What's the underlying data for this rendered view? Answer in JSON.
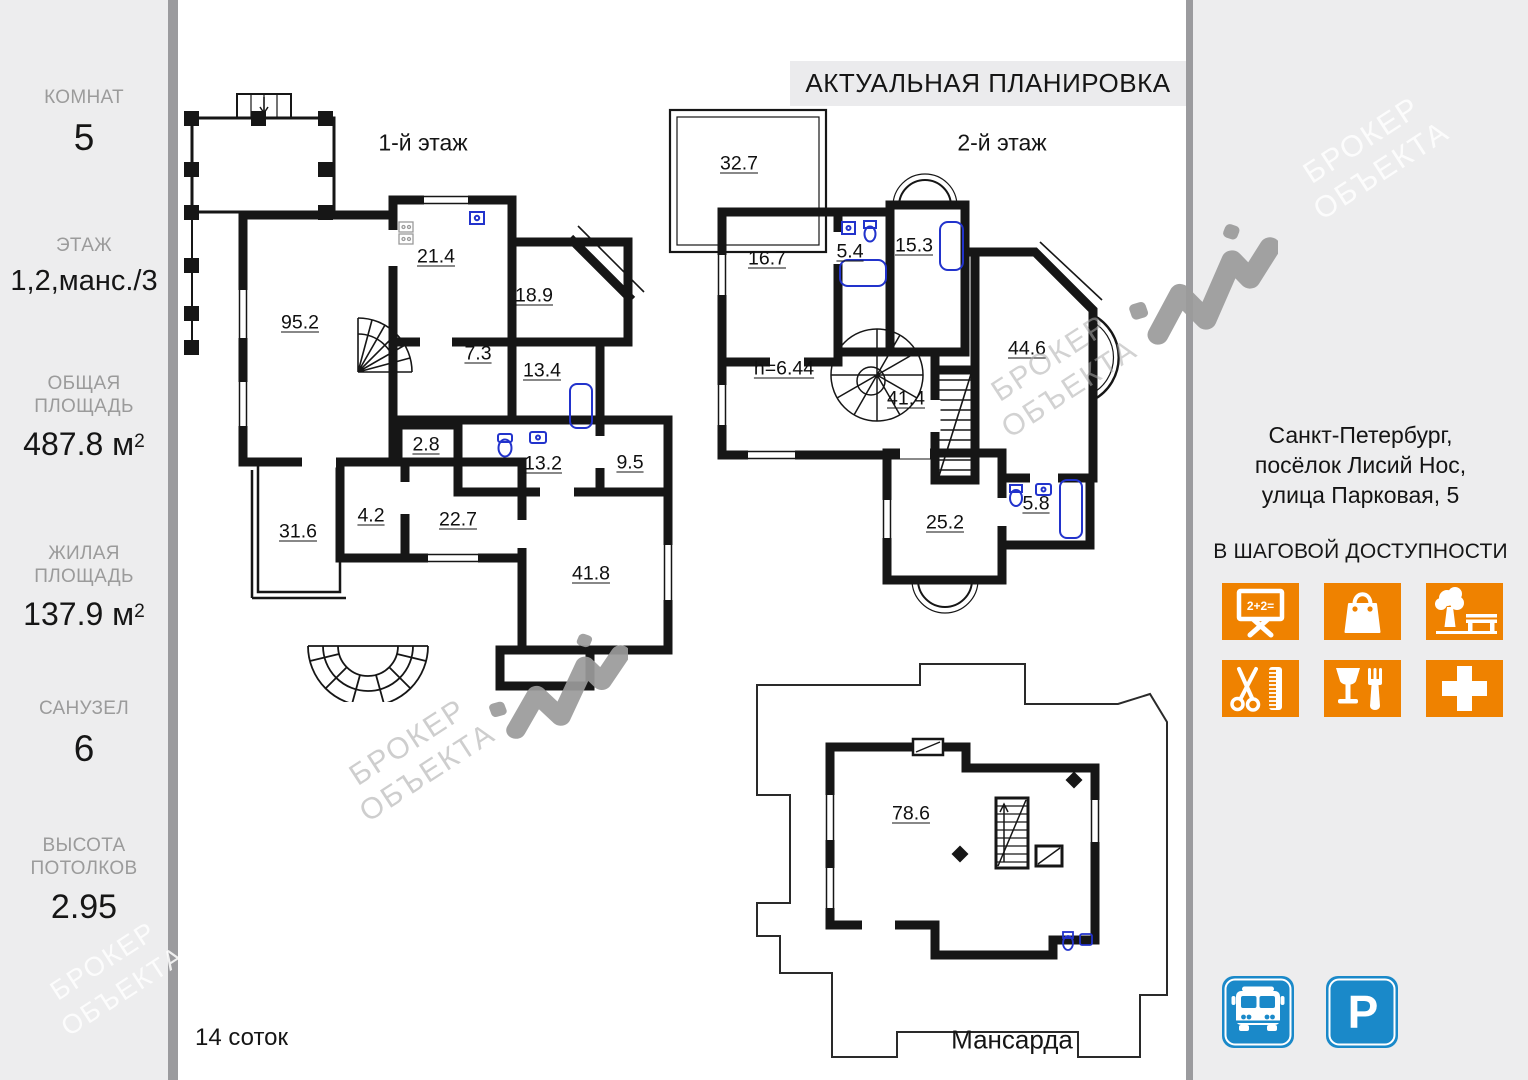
{
  "title": "АКТУАЛЬНАЯ ПЛАНИРОВКА",
  "sidebar": {
    "stats": [
      {
        "label": "КОМНАТ",
        "value": "5",
        "sup": ""
      },
      {
        "label": "ЭТАЖ",
        "value": "1,2,манс./3",
        "sup": ""
      },
      {
        "label": "ОБЩАЯ ПЛОЩАДЬ",
        "value": "487.8 м",
        "sup": "2"
      },
      {
        "label": "ЖИЛАЯ ПЛОЩАДЬ",
        "value": "137.9 м",
        "sup": "2"
      },
      {
        "label": "САНУЗЕЛ",
        "value": "6",
        "sup": ""
      },
      {
        "label": "ВЫСОТА ПОТОЛКОВ",
        "value": "2.95",
        "sup": ""
      }
    ]
  },
  "plans": {
    "floor1": {
      "label": "1-й этаж",
      "rooms": [
        "95.2",
        "21.4",
        "18.9",
        "7.3",
        "13.4",
        "2.8",
        "13.2",
        "9.5",
        "4.2",
        "31.6",
        "22.7",
        "41.8"
      ]
    },
    "floor2": {
      "label": "2-й этаж",
      "height_note": "h=6.44",
      "rooms": [
        "32.7",
        "16.7",
        "5.4",
        "15.3",
        "41.4",
        "44.6",
        "25.2",
        "5.8"
      ]
    },
    "mansard": {
      "label": "Мансарда",
      "rooms": [
        "78.6"
      ]
    }
  },
  "land_area": "14 соток",
  "address": {
    "line1": "Санкт-Петербург,",
    "line2": "посёлок Лисий Нос,",
    "line3": "улица Парковая, 5"
  },
  "nearby": {
    "heading": "В ШАГОВОЙ ДОСТУПНОСТИ",
    "school_text": "2+2=",
    "icons": [
      "school-icon",
      "shopping-icon",
      "park-icon",
      "hairdresser-icon",
      "restaurant-icon",
      "medical-icon"
    ]
  },
  "transport": {
    "icons": [
      "bus-icon",
      "parking-icon"
    ],
    "parking_label": "P"
  },
  "watermark": {
    "line1": "БРОКЕР",
    "line2": "ОБЪЕКТА"
  },
  "colors": {
    "orange": "#ef8200",
    "blue": "#1a89c9",
    "panel_grey": "#ededee",
    "separator_grey": "#9b9b9e",
    "wall": "#161616",
    "fixture_blue": "#2233cc"
  }
}
